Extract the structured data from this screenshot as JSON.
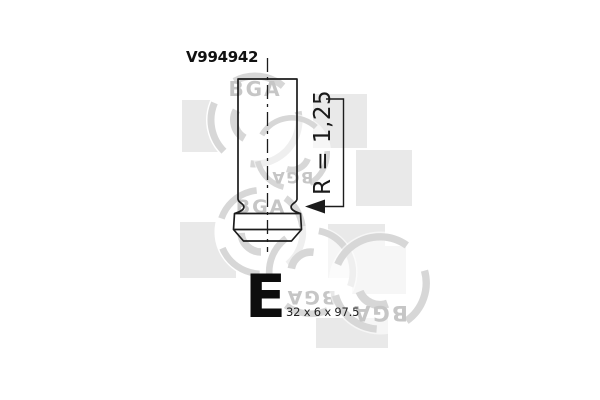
{
  "part": {
    "number": "V994942",
    "type_letter": "E",
    "dimensions": "32 x 6 x 97.5"
  },
  "drawing": {
    "radius_label": "R = 1,25"
  },
  "watermark": {
    "logo_text": "BGA"
  },
  "colors": {
    "drawing_line": "#1c1c1c",
    "label_text": "#111111",
    "watermark_square": "#e9e9e9",
    "watermark_ring": "#d7d7d7",
    "watermark_text": "#c6c6c6"
  }
}
